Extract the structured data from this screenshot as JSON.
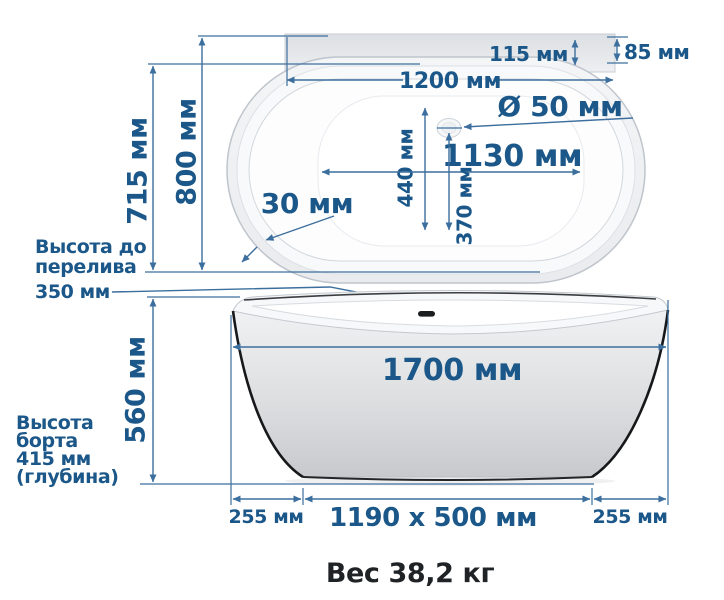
{
  "colors": {
    "label_blue": "#1b5788",
    "line_blue": "#3c6f9e",
    "dark_text": "#1f2326",
    "tub_outline": "#bfc5cc",
    "deck_gray": "#dfe2e6"
  },
  "top_view": {
    "outer_width_800": "800 мм",
    "inner_width_715": "715 мм",
    "length_1200": "1200 мм",
    "deck_offset_115": "115 мм",
    "deck_depth_85": "85 мм",
    "drain_diameter_50": "Ø 50 мм",
    "floor_length_1130": "1130 мм",
    "drain_offset_440": "440 мм",
    "drain_offset_370": "370 мм",
    "rim_thickness_30": "30 мм"
  },
  "overflow_note": {
    "line1": "Высота до",
    "line2": "перелива",
    "line3": "350 мм"
  },
  "side_view": {
    "length_1700": "1700 мм",
    "height_560": "560 мм",
    "base_size": "1190 x 500 мм",
    "left_offset_255": "255 мм",
    "right_offset_255": "255 мм",
    "depth_note": [
      "Высота",
      "борта",
      "415 мм",
      "(глубина)"
    ]
  },
  "footer": {
    "weight": "Вес 38,2 кг"
  }
}
